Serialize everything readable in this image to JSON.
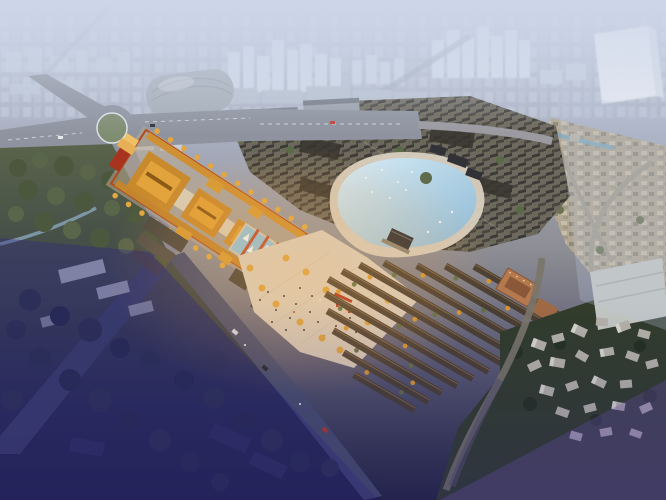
{
  "scene": {
    "kind": "aerial-architectural-rendering",
    "elements": [
      {
        "name": "hazy-city-skyline",
        "label": "distant high-rise city in haze"
      },
      {
        "name": "glass-tower",
        "label": "tall translucent tower block"
      },
      {
        "name": "convention-dome",
        "label": "large grey domed hall"
      },
      {
        "name": "roundabout",
        "label": "road roundabout with green island"
      },
      {
        "name": "commercial-strip",
        "label": "modern retail blocks"
      },
      {
        "name": "old-town-roofs",
        "label": "dense traditional grey-roof quarter"
      },
      {
        "name": "beige-town",
        "label": "existing town with canal"
      },
      {
        "name": "temple-complex",
        "label": "golden-roof temple axis with red walls"
      },
      {
        "name": "ginkgo-rows",
        "label": "rows of golden ginkgo trees"
      },
      {
        "name": "lake",
        "label": "lake with beach and pavilions"
      },
      {
        "name": "sail-pond",
        "label": "pond with white sail sculptures"
      },
      {
        "name": "festival-plaza",
        "label": "paved plaza with visitors"
      },
      {
        "name": "townhouse-rows",
        "label": "rows of dark-roof courtyard houses"
      },
      {
        "name": "brick-building",
        "label": "tan brick mid-rise"
      },
      {
        "name": "village-houses",
        "label": "light grey village houses"
      },
      {
        "name": "woodland",
        "label": "olive tree canopy"
      },
      {
        "name": "shadow-zone",
        "label": "deep blue evening shadow"
      }
    ]
  },
  "palette": {
    "sky_haze": "#c8d1e2",
    "city_far": "#c3cddb",
    "glass_tower": "#e9edf4",
    "dome_roof": "#a6aeb7",
    "road_lit": "#8e939f",
    "road_shadow": "#3c4460",
    "road_branch": "#474e6e",
    "roundabout_green": "#7f8d72",
    "woodland": "#4f5a40",
    "old_town_base": "#6e695e",
    "old_town_roof": "#3c3a36",
    "beige_town": "#b2a792",
    "temple_roof": "#c98a2e",
    "temple_roof_light": "#e3a33c",
    "temple_wall_red": "#b24a1c",
    "ginkgo": "#e2a73e",
    "lake_water": "#aed0e4",
    "lake_beach": "#d9d0c0",
    "pond_water": "#8fc2dc",
    "plaza": "#d7cdbf",
    "townhouse_roof": "#493f33",
    "townhouse_ridge": "#7e6344",
    "brick_building": "#b5794e",
    "village_house": "#b6b3a9",
    "village_ground": "#313c2a",
    "canal_water": "#7fa8b8",
    "shadow_purple": "rgba(47,42,128,0.38)",
    "warm_glow": "rgba(255,184,88,0.30)"
  }
}
